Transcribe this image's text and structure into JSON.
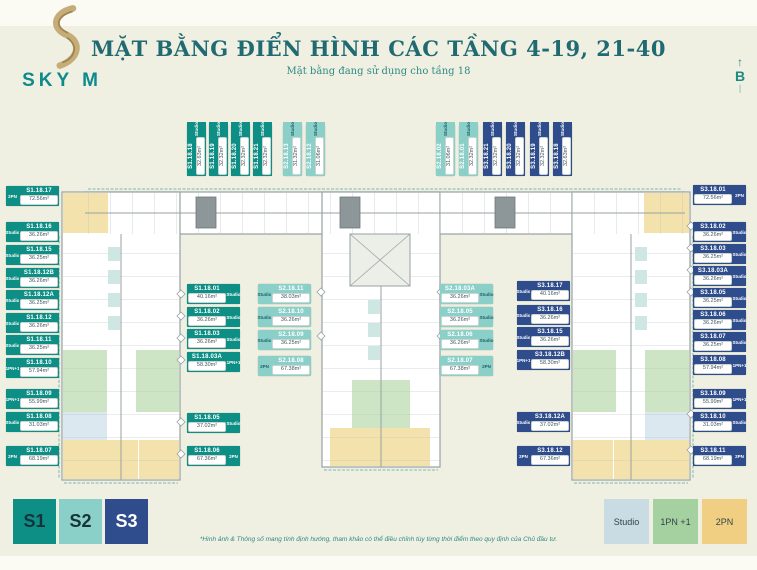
{
  "header": {
    "logo": {
      "brand": "SKY M"
    },
    "title": "MẶT BẰNG ĐIỂN HÌNH CÁC TẦNG 4-19, 21-40",
    "subtitle": "Mặt bằng đang sử dụng cho tầng 18",
    "compass": {
      "letter": "B",
      "arrow": "↑",
      "tail": "|"
    }
  },
  "plan": {
    "badges": [
      {
        "unit": "S1.18.17",
        "area": "72.56m²",
        "tag": "2PN",
        "c": "s1 tag-left",
        "x": 6,
        "y": 186
      },
      {
        "unit": "S1.18.16",
        "area": "36.26m²",
        "tag": "Studio",
        "c": "s1 tag-left",
        "x": 6,
        "y": 222
      },
      {
        "unit": "S1.18.15",
        "area": "36.25m²",
        "tag": "Studio",
        "c": "s1 tag-left",
        "x": 6,
        "y": 245
      },
      {
        "unit": "S1.18.12B",
        "area": "36.26m²",
        "tag": "Studio",
        "c": "s1 tag-left",
        "x": 6,
        "y": 268
      },
      {
        "unit": "S1.18.12A",
        "area": "36.25m²",
        "tag": "Studio",
        "c": "s1 tag-left",
        "x": 6,
        "y": 290
      },
      {
        "unit": "S1.18.12",
        "area": "36.26m²",
        "tag": "Studio",
        "c": "s1 tag-left",
        "x": 6,
        "y": 313
      },
      {
        "unit": "S1.18.11",
        "area": "36.25m²",
        "tag": "Studio",
        "c": "s1 tag-left",
        "x": 6,
        "y": 335
      },
      {
        "unit": "S1.18.10",
        "area": "57.94m²",
        "tag": "1PN+1",
        "c": "s1 tag-left",
        "x": 6,
        "y": 358
      },
      {
        "unit": "S1.18.09",
        "area": "55.99m²",
        "tag": "1PN+1",
        "c": "s1 tag-left",
        "x": 6,
        "y": 389
      },
      {
        "unit": "S1.18.08",
        "area": "31.03m²",
        "tag": "Studio",
        "c": "s1 tag-left",
        "x": 6,
        "y": 412
      },
      {
        "unit": "S1.18.07",
        "area": "68.19m²",
        "tag": "2PN",
        "c": "s1 tag-left",
        "x": 6,
        "y": 446
      },
      {
        "unit": "S1.18.01",
        "area": "40.16m²",
        "tag": "Studio",
        "c": "s1 tag-right",
        "x": 187,
        "y": 284
      },
      {
        "unit": "S1.18.02",
        "area": "36.26m²",
        "tag": "Studio",
        "c": "s1 tag-right",
        "x": 187,
        "y": 307
      },
      {
        "unit": "S1.18.03",
        "area": "36.26m²",
        "tag": "Studio",
        "c": "s1 tag-right",
        "x": 187,
        "y": 329
      },
      {
        "unit": "S1.18.03A",
        "area": "58.30m²",
        "tag": "1PN+1",
        "c": "s1 tag-right",
        "x": 187,
        "y": 352
      },
      {
        "unit": "S1.18.05",
        "area": "37.02m²",
        "tag": "Studio",
        "c": "s1 tag-right",
        "x": 187,
        "y": 413
      },
      {
        "unit": "S1.18.06",
        "area": "67.36m²",
        "tag": "2PN",
        "c": "s1 tag-right",
        "x": 187,
        "y": 446
      },
      {
        "unit": "S2.18.11",
        "area": "38.03m²",
        "tag": "Studio",
        "c": "s2 tag-left",
        "x": 258,
        "y": 284
      },
      {
        "unit": "S2.18.10",
        "area": "36.26m²",
        "tag": "Studio",
        "c": "s2 tag-left",
        "x": 258,
        "y": 307
      },
      {
        "unit": "S2.18.09",
        "area": "36.25m²",
        "tag": "Studio",
        "c": "s2 tag-left",
        "x": 258,
        "y": 330
      },
      {
        "unit": "S2.18.08",
        "area": "67.38m²",
        "tag": "2PN",
        "c": "s2 tag-left",
        "x": 258,
        "y": 356
      },
      {
        "unit": "S2.18.03A",
        "area": "36.26m²",
        "tag": "Studio",
        "c": "s2 tag-right",
        "x": 440,
        "y": 284
      },
      {
        "unit": "S2.18.05",
        "area": "36.26m²",
        "tag": "Studio",
        "c": "s2 tag-right",
        "x": 440,
        "y": 307
      },
      {
        "unit": "S2.18.06",
        "area": "36.26m²",
        "tag": "Studio",
        "c": "s2 tag-right",
        "x": 440,
        "y": 330
      },
      {
        "unit": "S2.18.07",
        "area": "67.38m²",
        "tag": "2PN",
        "c": "s2 tag-right",
        "x": 440,
        "y": 356
      },
      {
        "unit": "S3.18.17",
        "area": "40.16m²",
        "tag": "Studio",
        "c": "s3 tag-left",
        "x": 517,
        "y": 281
      },
      {
        "unit": "S3.18.16",
        "area": "36.26m²",
        "tag": "Studio",
        "c": "s3 tag-left",
        "x": 517,
        "y": 305
      },
      {
        "unit": "S3.18.15",
        "area": "36.26m²",
        "tag": "Studio",
        "c": "s3 tag-left",
        "x": 517,
        "y": 327
      },
      {
        "unit": "S3.18.12B",
        "area": "58.30m²",
        "tag": "1PN+1",
        "c": "s3 tag-left",
        "x": 517,
        "y": 350
      },
      {
        "unit": "S3.18.12A",
        "area": "37.02m²",
        "tag": "Studio",
        "c": "s3 tag-left",
        "x": 517,
        "y": 412
      },
      {
        "unit": "S3.18.12",
        "area": "67.36m²",
        "tag": "2PN",
        "c": "s3 tag-left",
        "x": 517,
        "y": 446
      },
      {
        "unit": "S3.18.01",
        "area": "72.56m²",
        "tag": "2PN",
        "c": "s3 tag-right",
        "x": 693,
        "y": 185
      },
      {
        "unit": "S3.18.02",
        "area": "36.26m²",
        "tag": "Studio",
        "c": "s3 tag-right",
        "x": 693,
        "y": 222
      },
      {
        "unit": "S3.18.03",
        "area": "36.25m²",
        "tag": "Studio",
        "c": "s3 tag-right",
        "x": 693,
        "y": 244
      },
      {
        "unit": "S3.18.03A",
        "area": "36.26m²",
        "tag": "Studio",
        "c": "s3 tag-right",
        "x": 693,
        "y": 266
      },
      {
        "unit": "S3.18.05",
        "area": "36.25m²",
        "tag": "Studio",
        "c": "s3 tag-right",
        "x": 693,
        "y": 288
      },
      {
        "unit": "S3.18.06",
        "area": "36.26m²",
        "tag": "Studio",
        "c": "s3 tag-right",
        "x": 693,
        "y": 310
      },
      {
        "unit": "S3.18.07",
        "area": "36.25m²",
        "tag": "Studio",
        "c": "s3 tag-right",
        "x": 693,
        "y": 332
      },
      {
        "unit": "S3.18.08",
        "area": "57.94m²",
        "tag": "1PN+1",
        "c": "s3 tag-right",
        "x": 693,
        "y": 355
      },
      {
        "unit": "S3.18.09",
        "area": "55.99m²",
        "tag": "1PN+1",
        "c": "s3 tag-right",
        "x": 693,
        "y": 389
      },
      {
        "unit": "S3.18.10",
        "area": "31.03m²",
        "tag": "Studio",
        "c": "s3 tag-right",
        "x": 693,
        "y": 412
      },
      {
        "unit": "S3.18.11",
        "area": "68.19m²",
        "tag": "2PN",
        "c": "s3 tag-right",
        "x": 693,
        "y": 446
      },
      {
        "unit": "S1.18.18",
        "area": "32.63m²",
        "tag": "Studio",
        "c": "s1 vert",
        "x": 187,
        "y": 124
      },
      {
        "unit": "S1.18.19",
        "area": "32.32m²",
        "tag": "Studio",
        "c": "s1 vert",
        "x": 209,
        "y": 124
      },
      {
        "unit": "S1.18.20",
        "area": "32.32m²",
        "tag": "Studio",
        "c": "s1 vert",
        "x": 231,
        "y": 124
      },
      {
        "unit": "S1.18.21",
        "area": "32.32m²",
        "tag": "Studio",
        "c": "s1 vert",
        "x": 253,
        "y": 124
      },
      {
        "unit": "S2.18.13",
        "area": "31.32m²",
        "tag": "Studio",
        "c": "s2 vert",
        "x": 283,
        "y": 124
      },
      {
        "unit": "S2.18.12",
        "area": "31.06m²",
        "tag": "Studio",
        "c": "s2 vert",
        "x": 306,
        "y": 124
      },
      {
        "unit": "S2.18.02",
        "area": "31.06m²",
        "tag": "Studio",
        "c": "s2 vert",
        "x": 436,
        "y": 124
      },
      {
        "unit": "S2.18.01",
        "area": "32.32m²",
        "tag": "Studio",
        "c": "s2 vert",
        "x": 459,
        "y": 124
      },
      {
        "unit": "S3.18.21",
        "area": "32.32m²",
        "tag": "Studio",
        "c": "s3 vert",
        "x": 483,
        "y": 124
      },
      {
        "unit": "S3.18.20",
        "area": "32.32m²",
        "tag": "Studio",
        "c": "s3 vert",
        "x": 506,
        "y": 124
      },
      {
        "unit": "S3.18.19",
        "area": "32.32m²",
        "tag": "Studio",
        "c": "s3 vert",
        "x": 530,
        "y": 124
      },
      {
        "unit": "S3.18.18",
        "area": "32.63m²",
        "tag": "Studio",
        "c": "s3 vert",
        "x": 553,
        "y": 124
      }
    ]
  },
  "legend": {
    "towers": [
      {
        "label": "S1",
        "bg": "#0e8f86",
        "fg": "#15333a"
      },
      {
        "label": "S2",
        "bg": "#8ad0c9",
        "fg": "#15333a"
      },
      {
        "label": "S3",
        "bg": "#2f4d8d",
        "fg": "#ffffff"
      }
    ],
    "types": [
      {
        "label": "Studio",
        "bg": "#c9dbe3"
      },
      {
        "label": "1PN +1",
        "bg": "#a5d0a0"
      },
      {
        "label": "2PN",
        "bg": "#f0cf82"
      }
    ]
  },
  "footnote": "*Hình ảnh & Thông số mang tính định hướng, tham khảo có thể điều chỉnh tùy từng thời điểm theo quy định của Chủ đầu tư."
}
